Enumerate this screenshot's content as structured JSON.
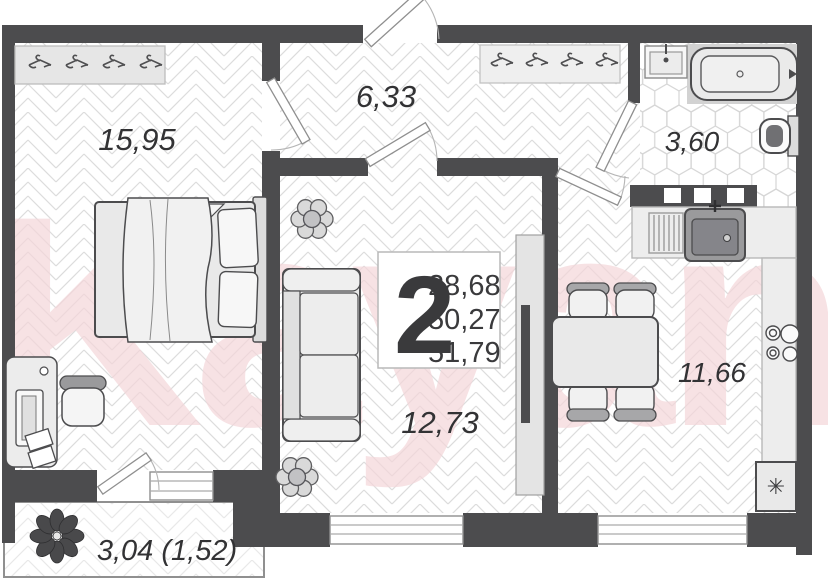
{
  "watermark": "Kayan",
  "info_box": {
    "rooms_count": "2",
    "living_area": "28,68",
    "apartment_area": "50,27",
    "total_area": "51,79"
  },
  "labels": {
    "bedroom": "15,95",
    "hallway": "6,33",
    "bathroom": "3,60",
    "living_room": "12,73",
    "kitchen": "11,66",
    "balcony": "3,04 (1,52)"
  },
  "icons": {
    "fridge_glyph": "✳",
    "hanger": "clothes-hanger",
    "plant": "potted-plant"
  },
  "colors": {
    "wall": "#4c4c4e",
    "floor_line": "#dcdcdc",
    "furniture_fill": "#e9e9e9",
    "watermark_pink": "#f4d7da",
    "label_text": "#323234"
  }
}
